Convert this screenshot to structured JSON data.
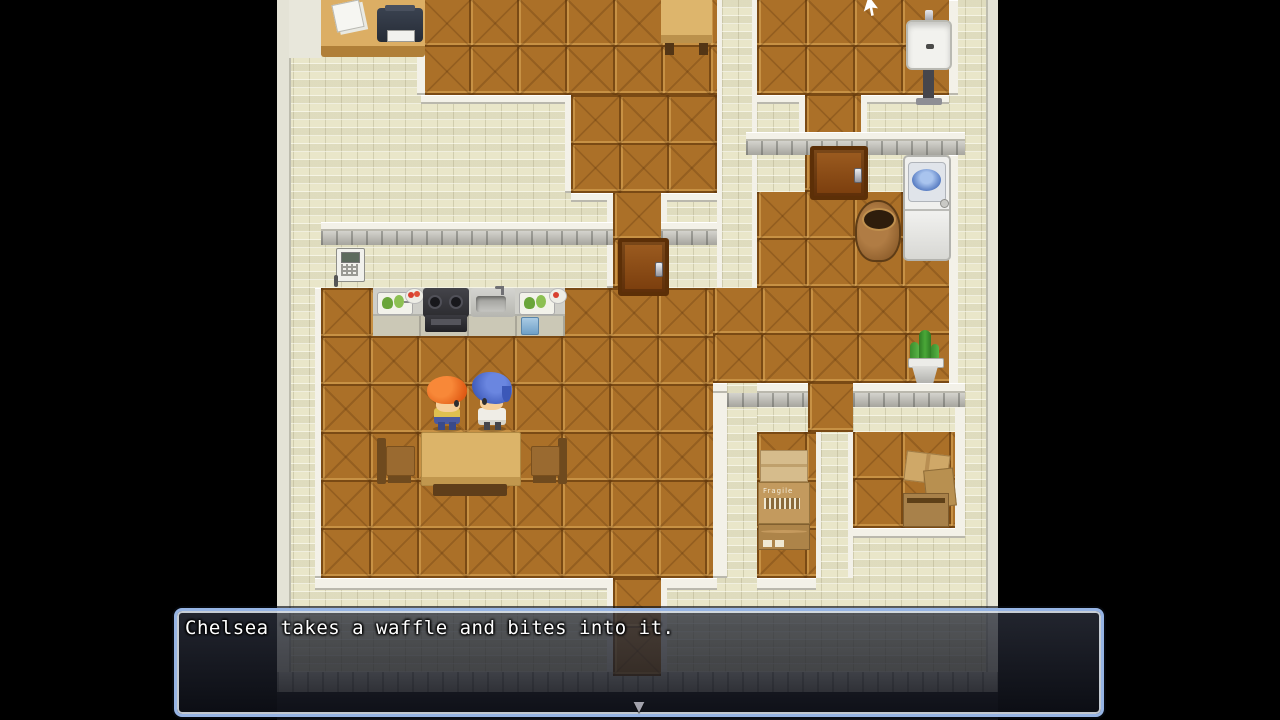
{
  "scene": {
    "description": "Top-down RPG Maker style house interior with office, bathroom, laundry, kitchen-dining room, hallway and storage rooms"
  },
  "dialogue": {
    "text": "Chelsea takes a waffle and bites into it.",
    "continue_indicator": "▼"
  },
  "labels": {
    "box_stamp": "Fragile"
  },
  "palette": {
    "letterbox": "#000000",
    "wall_brick": "#e9e6c9",
    "wood_floor": "#ab7028",
    "wall_cap_stone": "#b9b8b2",
    "dialog_border": "#96b4e4",
    "dialog_background": "rgba(20,24,34,0.8)",
    "door": "#8a4a12",
    "left_character_hair": "#e8661e",
    "right_character_hair": "#4764c8"
  }
}
